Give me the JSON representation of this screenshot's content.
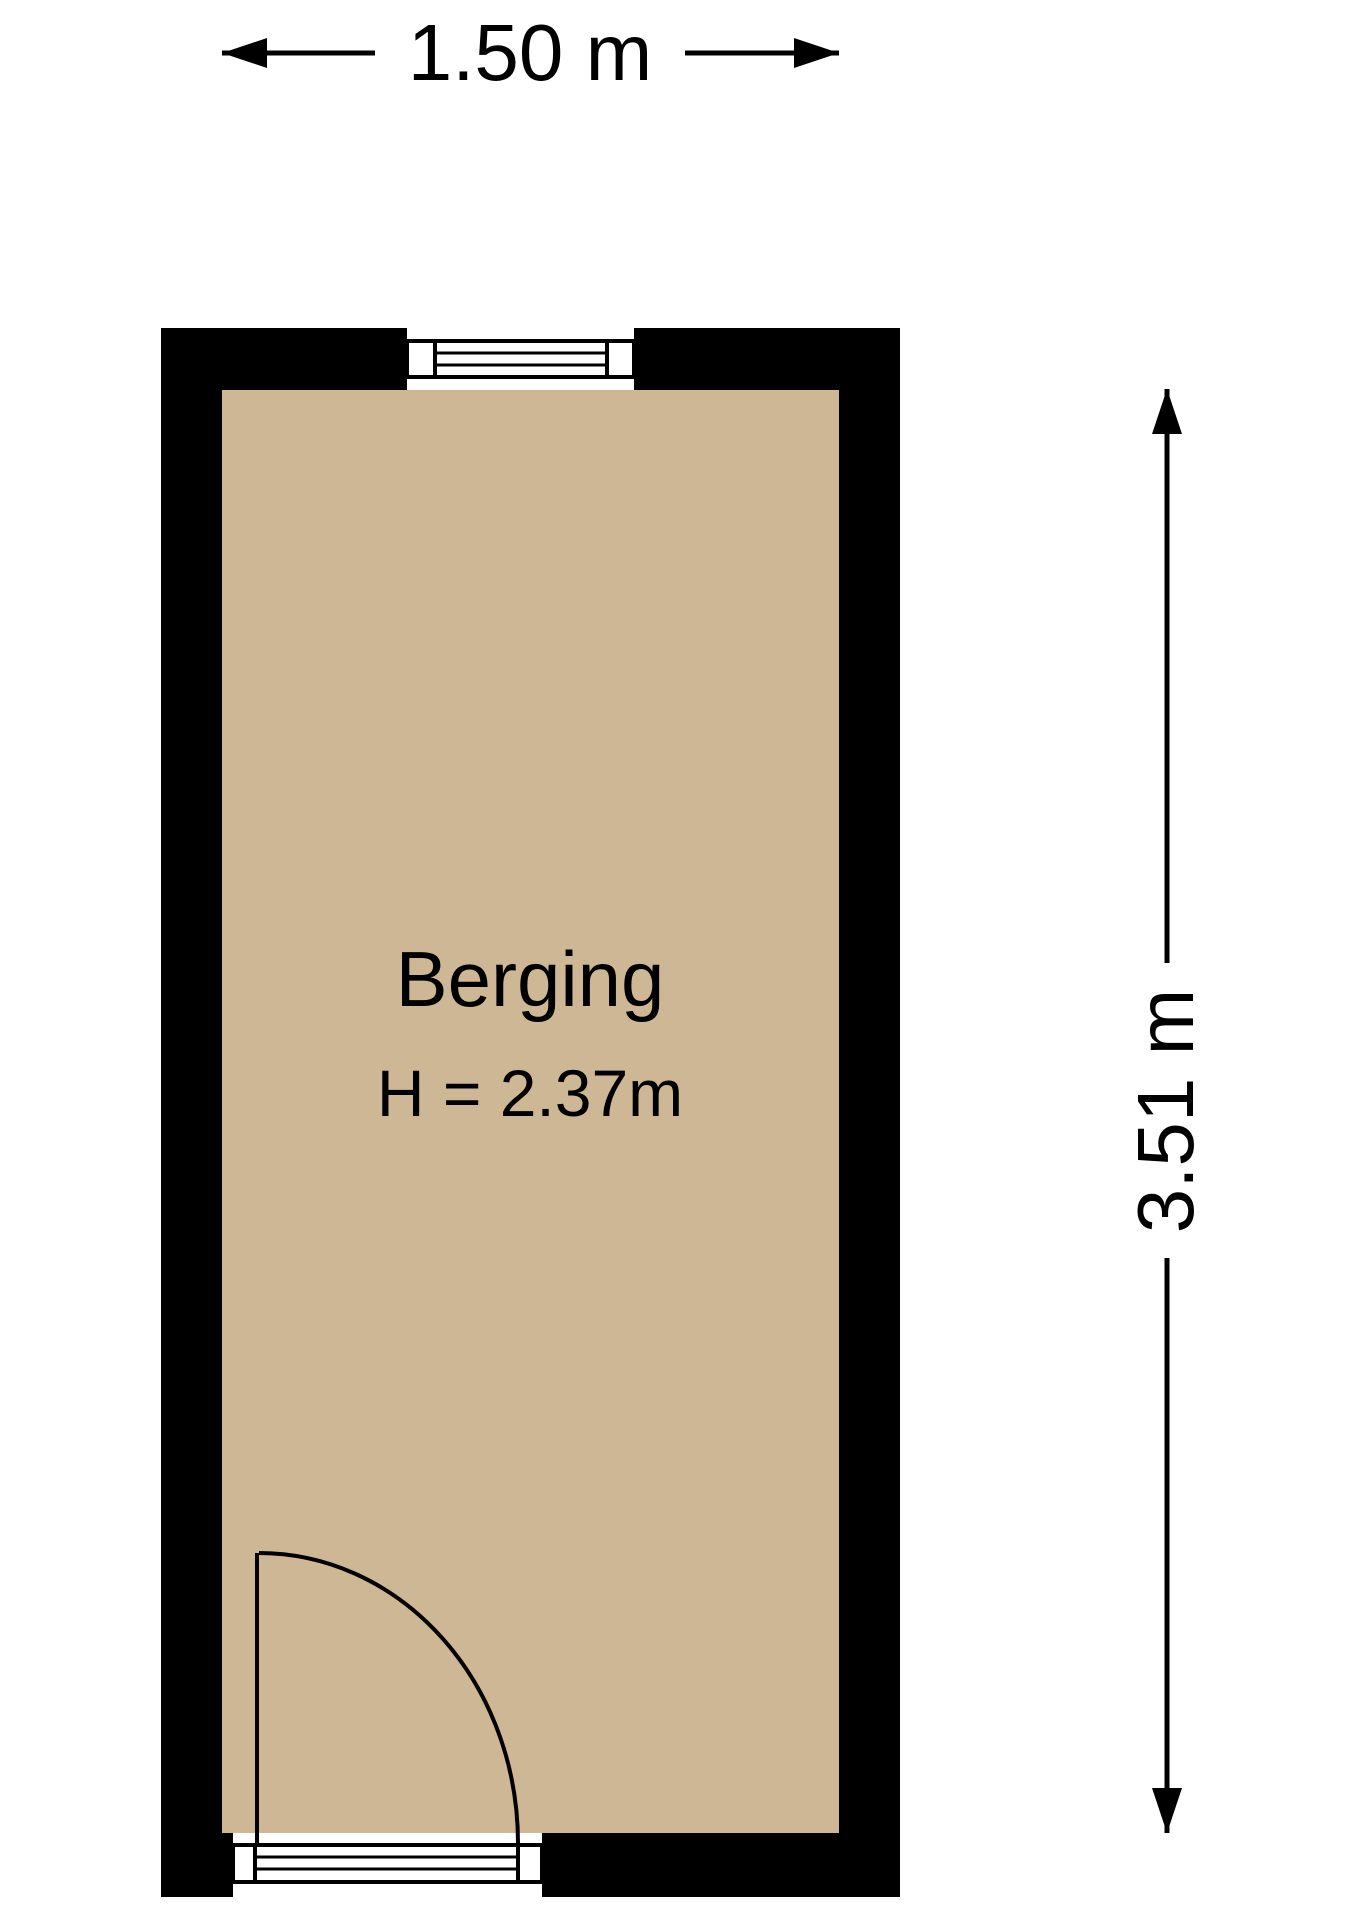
{
  "floorplan": {
    "room": {
      "name": "Berging",
      "ceiling_height_label": "H = 2.37m"
    },
    "dimensions": {
      "width_label": "1.50 m",
      "depth_label": "3.51 m"
    },
    "colors": {
      "wall": "#000000",
      "floor": "#ceb795",
      "line": "#000000",
      "background": "#ffffff"
    }
  }
}
